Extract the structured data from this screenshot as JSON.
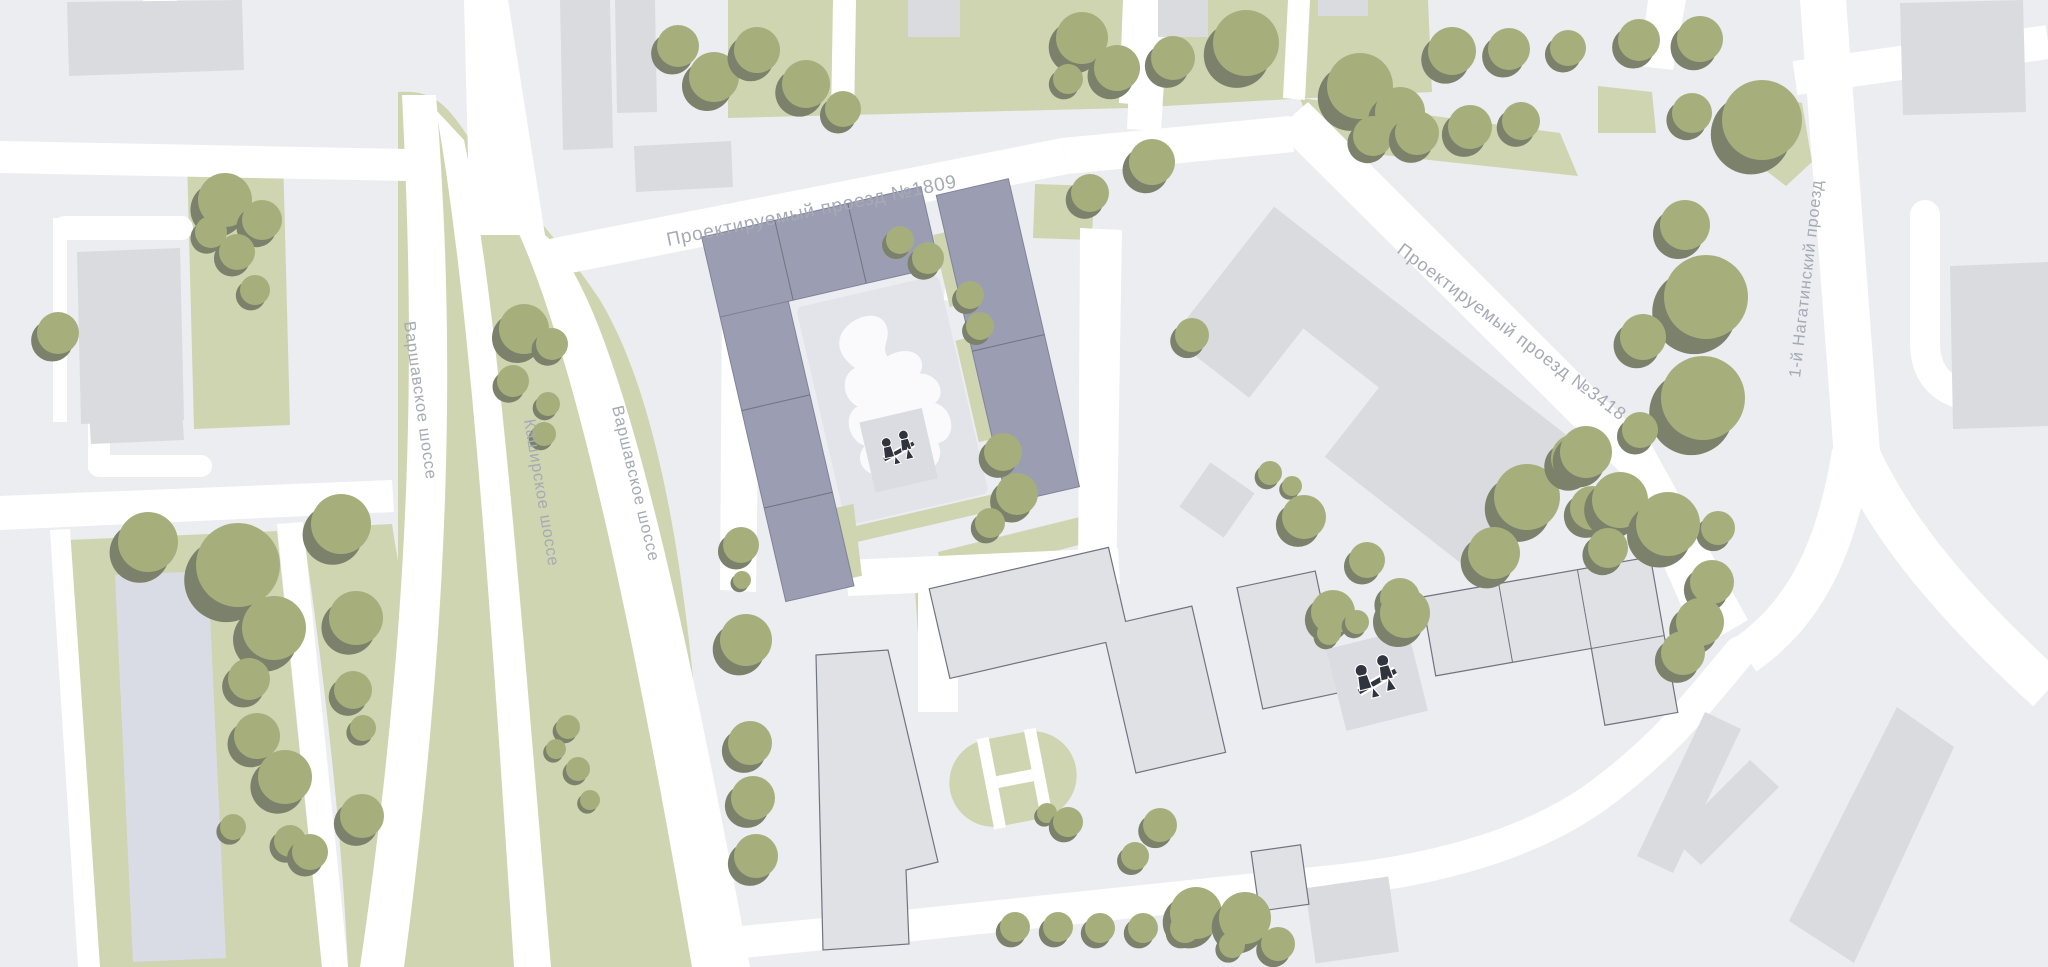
{
  "map": {
    "kind": "architectural-site-plan",
    "street_labels": {
      "varshavskoye_left": "Варшавское шоссе",
      "kashirskoye": "Каширское шоссе",
      "varshavskoye_right": "Варшавское шоссе",
      "proezd_1809": "Проектируемый проезд №1809",
      "proezd_3418": "Проектируемый проезд №3418",
      "nagatinsky": "1-й Нагатинский проезд"
    },
    "icons": [
      {
        "name": "playground-seesaw-icon",
        "count": 2
      }
    ],
    "colors": {
      "bg": "#EBEDF1",
      "road": "#FFFFFF",
      "green": "#CFD5B0",
      "tree": "#A6AF7C",
      "tree_shadow": "#7B816B",
      "building": "#D9DBDF",
      "building_lavender": "#DADCE5",
      "building_outlined": "#DFE1E5",
      "outline": "#70747E",
      "highlight_building": "#9B9DB2",
      "highlight_stroke": "#80829A",
      "courtyard": "#E3E4E9",
      "playground_pad": "#DBDCE1",
      "icon_dark": "#30343F",
      "label_text": "#A6AAB4"
    },
    "trees": [
      [
        225,
        200,
        27
      ],
      [
        262,
        220,
        20
      ],
      [
        237,
        252,
        18
      ],
      [
        255,
        290,
        15
      ],
      [
        211,
        232,
        16
      ],
      [
        58,
        333,
        21
      ],
      [
        148,
        542,
        30
      ],
      [
        238,
        565,
        42
      ],
      [
        274,
        628,
        32
      ],
      [
        249,
        679,
        21
      ],
      [
        257,
        736,
        23
      ],
      [
        285,
        777,
        27
      ],
      [
        290,
        841,
        16
      ],
      [
        233,
        827,
        13
      ],
      [
        341,
        524,
        30
      ],
      [
        356,
        618,
        27
      ],
      [
        353,
        690,
        19
      ],
      [
        363,
        728,
        13
      ],
      [
        362,
        816,
        22
      ],
      [
        310,
        852,
        18
      ],
      [
        524,
        329,
        25
      ],
      [
        552,
        344,
        16
      ],
      [
        513,
        381,
        16
      ],
      [
        548,
        404,
        12
      ],
      [
        544,
        434,
        12
      ],
      [
        568,
        727,
        12
      ],
      [
        556,
        749,
        10
      ],
      [
        578,
        769,
        12
      ],
      [
        590,
        800,
        10
      ],
      [
        678,
        46,
        21
      ],
      [
        714,
        77,
        25
      ],
      [
        757,
        50,
        23
      ],
      [
        806,
        84,
        24
      ],
      [
        843,
        109,
        18
      ],
      [
        1082,
        38,
        26
      ],
      [
        1117,
        68,
        23
      ],
      [
        1068,
        79,
        15
      ],
      [
        1173,
        58,
        22
      ],
      [
        1246,
        43,
        33
      ],
      [
        1360,
        86,
        33
      ],
      [
        1400,
        112,
        25
      ],
      [
        1452,
        51,
        24
      ],
      [
        1509,
        49,
        21
      ],
      [
        1568,
        48,
        18
      ],
      [
        1373,
        136,
        20
      ],
      [
        1417,
        133,
        22
      ],
      [
        1470,
        127,
        22
      ],
      [
        1521,
        121,
        19
      ],
      [
        1152,
        162,
        23
      ],
      [
        1090,
        193,
        19
      ],
      [
        900,
        240,
        14
      ],
      [
        928,
        258,
        16
      ],
      [
        741,
        545,
        18
      ],
      [
        742,
        580,
        9
      ],
      [
        746,
        640,
        26
      ],
      [
        750,
        743,
        22
      ],
      [
        753,
        798,
        22
      ],
      [
        756,
        856,
        22
      ],
      [
        970,
        295,
        14
      ],
      [
        980,
        326,
        14
      ],
      [
        1003,
        452,
        19
      ],
      [
        1017,
        494,
        21
      ],
      [
        990,
        523,
        15
      ],
      [
        1047,
        813,
        10
      ],
      [
        1068,
        822,
        15
      ],
      [
        1160,
        825,
        17
      ],
      [
        1135,
        856,
        14
      ],
      [
        1196,
        913,
        26
      ],
      [
        1245,
        918,
        26
      ],
      [
        1278,
        944,
        17
      ],
      [
        1015,
        927,
        15
      ],
      [
        1058,
        927,
        15
      ],
      [
        1100,
        928,
        15
      ],
      [
        1143,
        928,
        15
      ],
      [
        1185,
        928,
        15
      ],
      [
        1232,
        945,
        13
      ],
      [
        1192,
        335,
        17
      ],
      [
        1270,
        473,
        12
      ],
      [
        1292,
        486,
        10
      ],
      [
        1304,
        517,
        22
      ],
      [
        1367,
        560,
        18
      ],
      [
        1400,
        598,
        20
      ],
      [
        1527,
        497,
        33
      ],
      [
        1575,
        458,
        24
      ],
      [
        1592,
        508,
        22
      ],
      [
        1494,
        553,
        26
      ],
      [
        1718,
        528,
        17
      ],
      [
        1712,
        582,
        22
      ],
      [
        1700,
        622,
        24
      ],
      [
        1683,
        653,
        22
      ],
      [
        1333,
        612,
        22
      ],
      [
        1357,
        622,
        12
      ],
      [
        1329,
        633,
        12
      ],
      [
        1405,
        613,
        25
      ],
      [
        1639,
        40,
        21
      ],
      [
        1700,
        39,
        23
      ],
      [
        1762,
        120,
        40
      ],
      [
        1692,
        113,
        20
      ],
      [
        1685,
        225,
        25
      ],
      [
        1706,
        297,
        42
      ],
      [
        1643,
        337,
        23
      ],
      [
        1703,
        398,
        42
      ],
      [
        1640,
        430,
        18
      ],
      [
        1586,
        452,
        26
      ],
      [
        1620,
        500,
        28
      ],
      [
        1668,
        524,
        32
      ],
      [
        1608,
        548,
        20
      ]
    ]
  }
}
